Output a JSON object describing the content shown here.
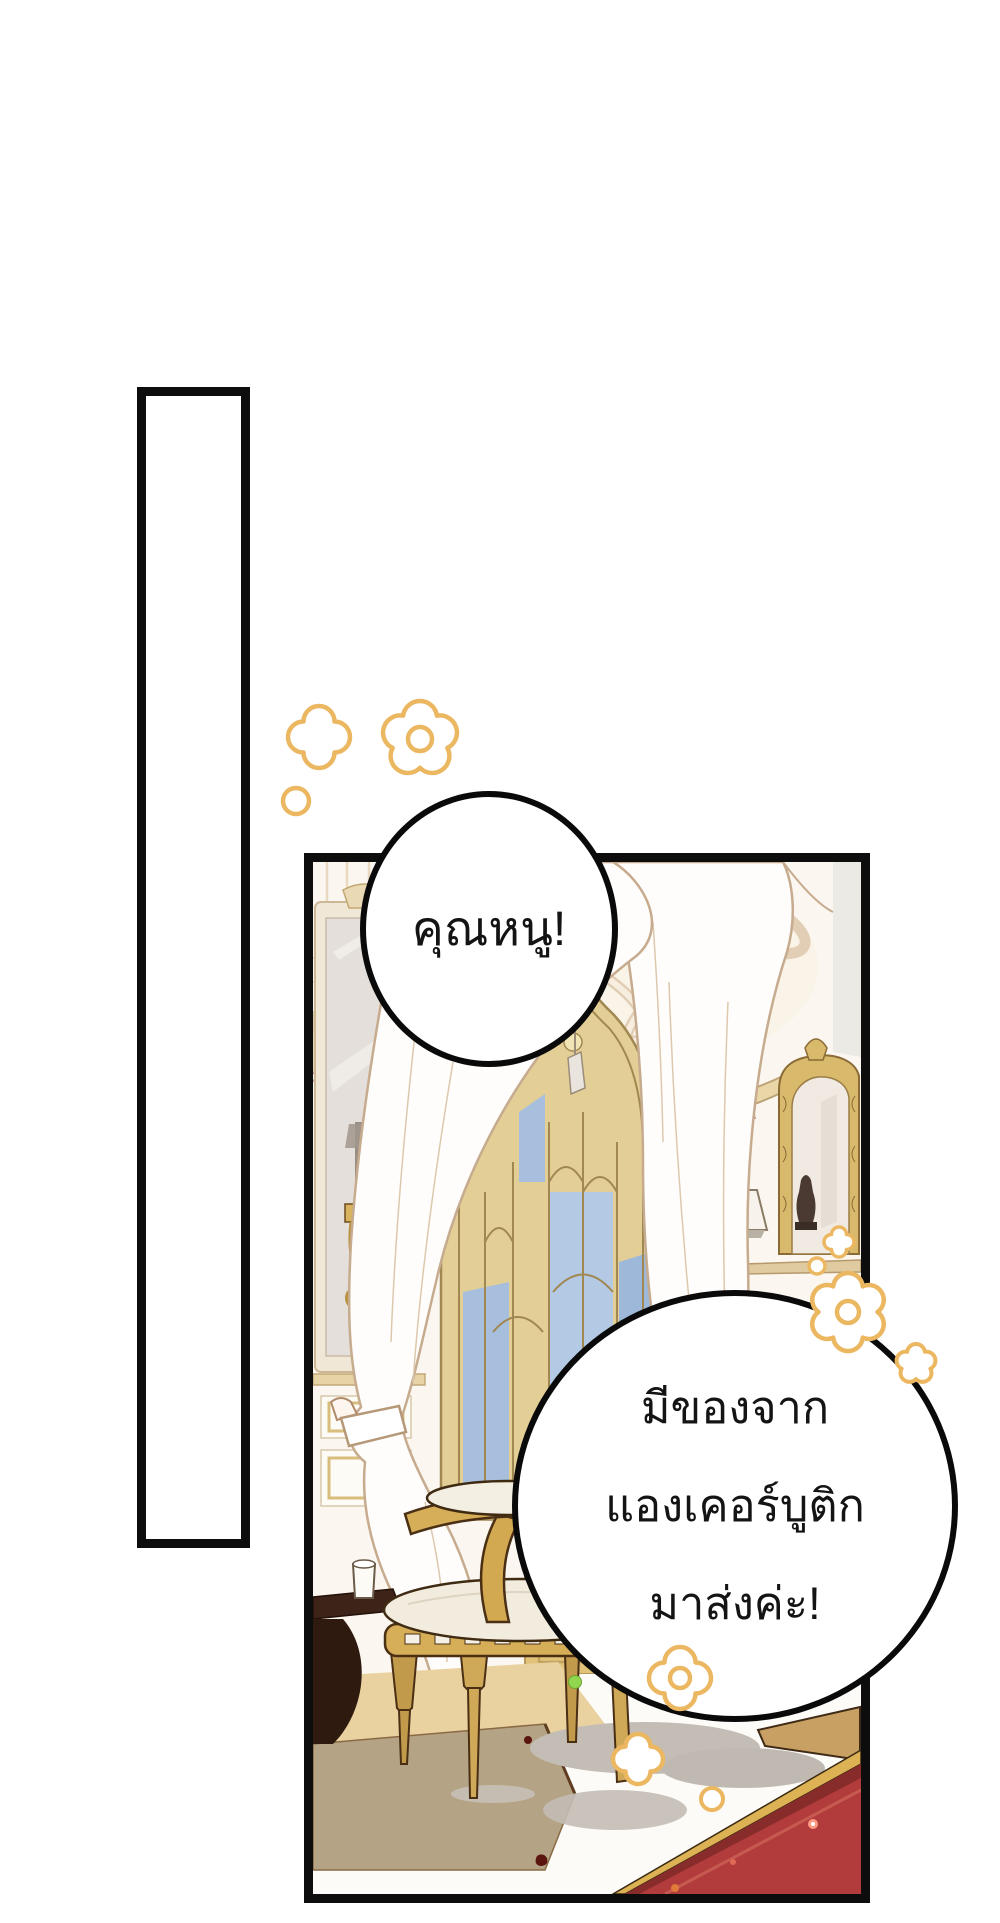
{
  "page": {
    "background_color": "#ffffff",
    "panel_border_color": "#0d0d0d"
  },
  "speech_bubbles": {
    "exclaim": {
      "text": "คุณหนู!"
    },
    "delivery": {
      "line1": "มีของจาก",
      "line2": "แองเคอร์บูติก",
      "line3": "มาส่งค่ะ!"
    }
  },
  "decorations": {
    "flower_outline_color": "#ECB761",
    "flower_fill_color": "#ffffff"
  },
  "artwork_colors": {
    "wall_cream": "#fbf7f0",
    "window_gold": "#e3cf96",
    "sky_blue": "#a7bfdc",
    "curtain_white": "#fefdfb",
    "carpet_red": "#b23c3c",
    "carpet_trim_gold": "#dcb254",
    "chair_gold": "#d2aa55",
    "shadow_taupe": "#b5a385",
    "garland_rose": "#c79e8b",
    "sparkle_green": "#90d64e"
  }
}
